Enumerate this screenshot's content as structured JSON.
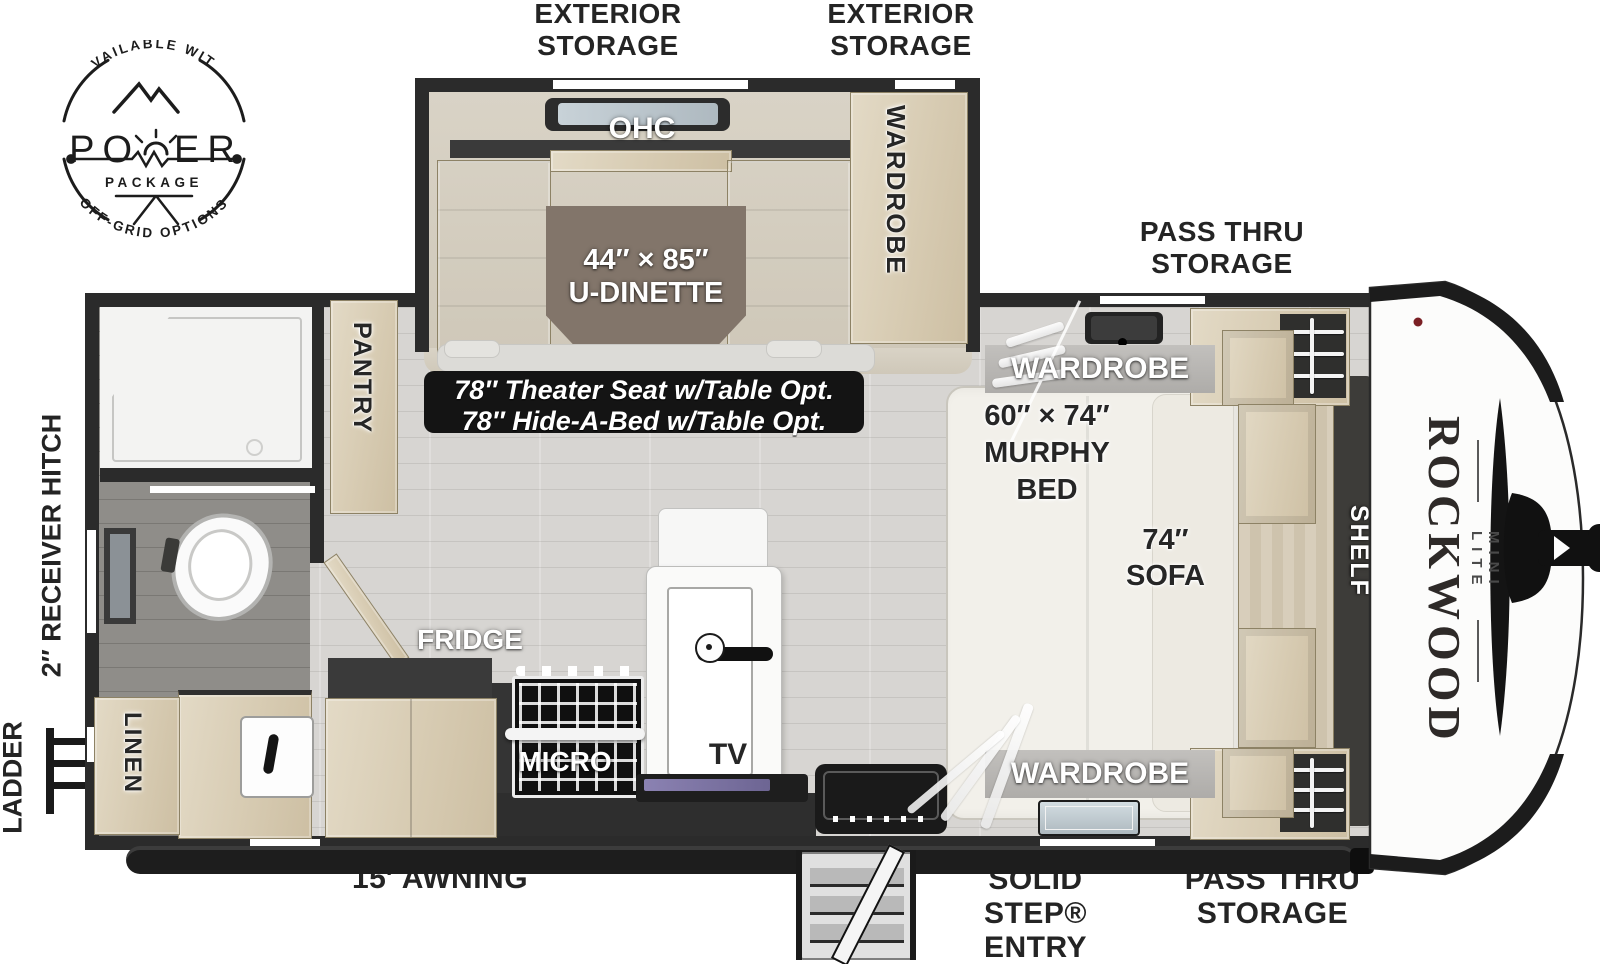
{
  "logo": {
    "available_with": "AVAILABLE WITH",
    "po": "PO",
    "er": "ER",
    "package": "PACKAGE",
    "off_grid": "OFF-GRID OPTIONS"
  },
  "exterior": {
    "exterior_storage_left": {
      "line1": "EXTERIOR",
      "line2": "STORAGE"
    },
    "exterior_storage_right": {
      "line1": "EXTERIOR",
      "line2": "STORAGE"
    },
    "pass_thru_top": {
      "line1": "PASS THRU",
      "line2": "STORAGE"
    },
    "pass_thru_bottom": {
      "line1": "PASS THRU",
      "line2": "STORAGE"
    },
    "solid_step": {
      "line1": "SOLID STEP®",
      "line2": "ENTRY"
    },
    "awning": "15′ AWNING",
    "receiver_hitch": "2″ RECEIVER HITCH",
    "ladder": "LADDER"
  },
  "slide": {
    "ohc": "OHC",
    "dinette_size": "44″ × 85″",
    "dinette_name": "U-DINETTE",
    "wardrobe": "WARDROBE"
  },
  "options": {
    "line1": "78″ Theater Seat w/Table Opt.",
    "line2": "78″ Hide-A-Bed w/Table Opt."
  },
  "kitchen": {
    "pantry": "PANTRY",
    "fridge": "FRIDGE",
    "micro": "MICRO",
    "tv": "TV"
  },
  "bath": {
    "linen": "LINEN"
  },
  "front": {
    "wardrobe_top": "WARDROBE",
    "murphy_size": "60″ × 74″",
    "murphy1": "MURPHY",
    "murphy2": "BED",
    "sofa_size": "74″",
    "sofa": "SOFA",
    "shelf": "SHELF",
    "wardrobe_bottom": "WARDROBE",
    "brand": "ROCKWOOD",
    "model": "MINI LITE"
  },
  "colors": {
    "wall": "#2b2b2b",
    "wood_light": "#e3dac6",
    "wood_dark": "#cdbfa3",
    "floor": "#d7d5d2",
    "bath_floor": "#8f8d89",
    "slide_floor": "#d5cec0",
    "table": "#82756a",
    "bed": "#f2f0ea",
    "label_dark": "#262626",
    "tv_screen": "#7d74a4"
  }
}
